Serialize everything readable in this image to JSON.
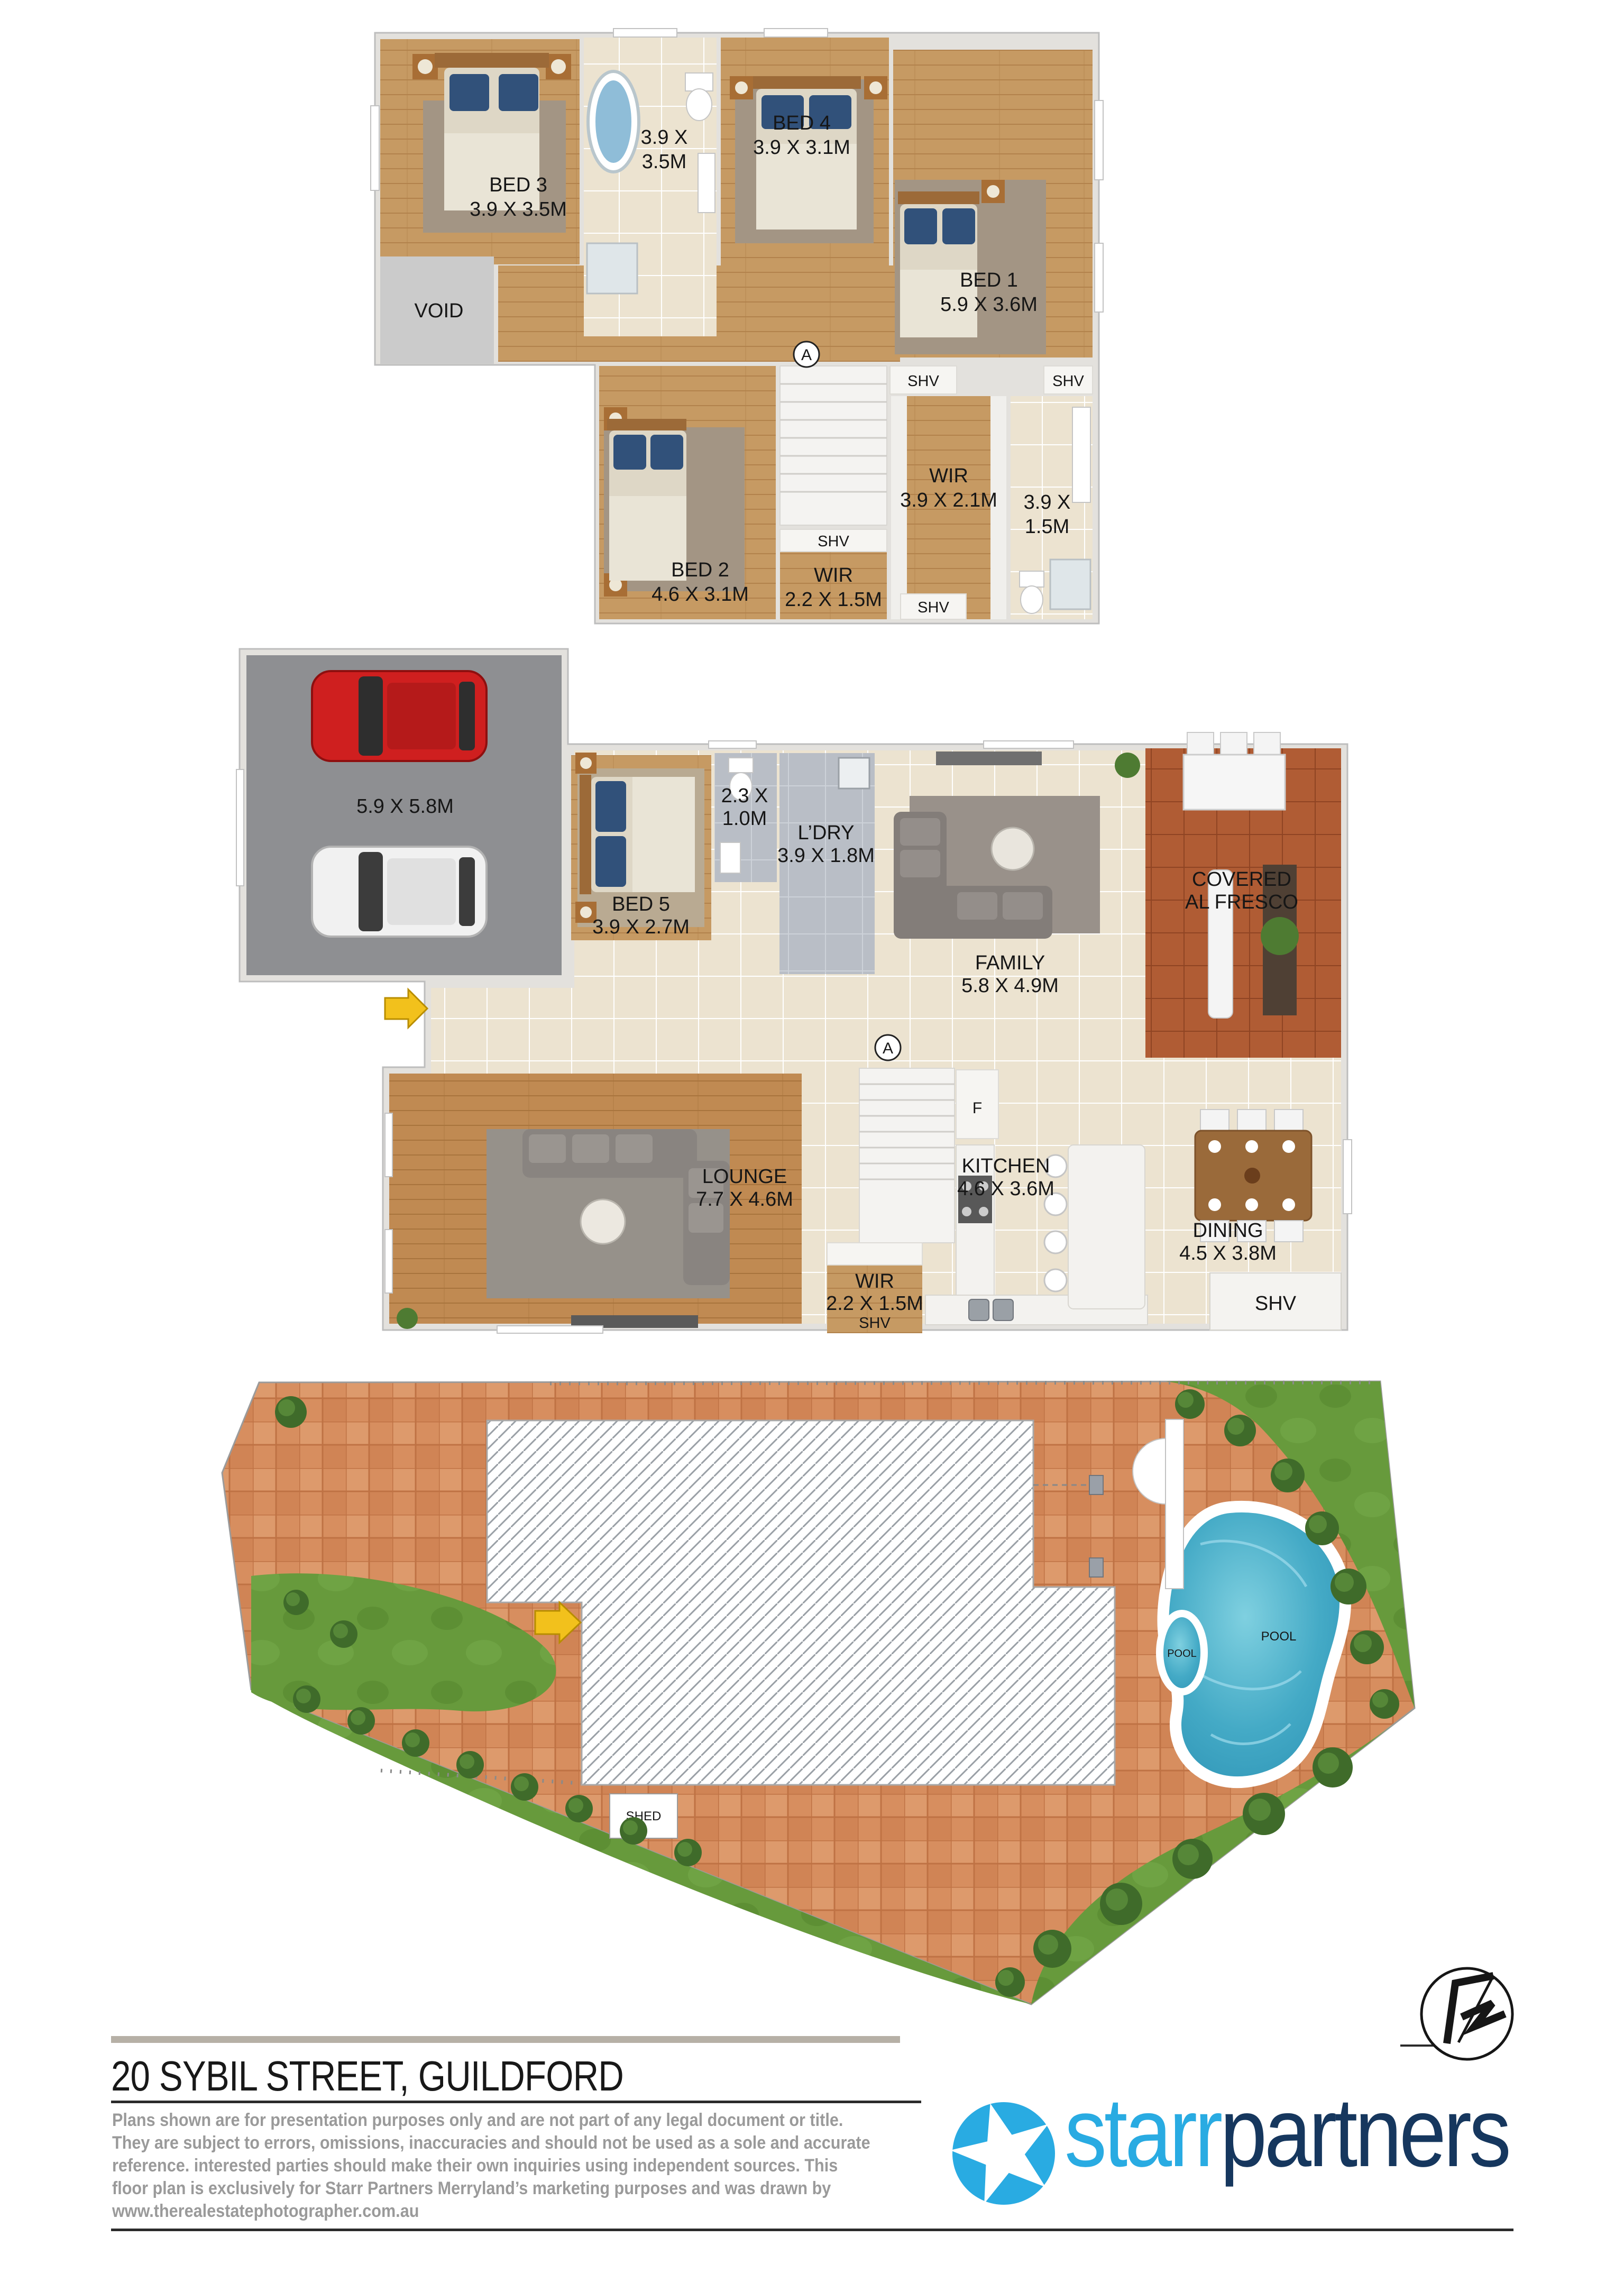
{
  "upper": {
    "bed3_name": "BED 3",
    "bed3_dims": "3.9 X 3.5M",
    "bath_dims_l1": "3.9 X",
    "bath_dims_l2": "3.5M",
    "bed4_name": "BED 4",
    "bed4_dims": "3.9 X 3.1M",
    "bed1_name": "BED 1",
    "bed1_dims": "5.9 X 3.6M",
    "void_label": "VOID",
    "section_marker": "A",
    "shv_a": "SHV",
    "shv_b": "SHV",
    "shv_c": "SHV",
    "shv_d": "SHV",
    "wir_name": "WIR",
    "wir_dims": "3.9 X 2.1M",
    "ens_dims_l1": "3.9 X",
    "ens_dims_l2": "1.5M",
    "bed2_name": "BED 2",
    "bed2_dims": "4.6 X 3.1M",
    "wir2_name": "WIR",
    "wir2_dims": "2.2 X 1.5M"
  },
  "ground": {
    "garage_dims": "5.9 X 5.8M",
    "bed5_name": "BED 5",
    "bed5_dims": "3.9 X 2.7M",
    "powder_dims_l1": "2.3 X",
    "powder_dims_l2": "1.0M",
    "ldry_name": "L’DRY",
    "ldry_dims": "3.9 X 1.8M",
    "family_name": "FAMILY",
    "family_dims": "5.8 X 4.9M",
    "alfresco_l1": "COVERED",
    "alfresco_l2": "AL FRESCO",
    "lounge_name": "LOUNGE",
    "lounge_dims": "7.7 X 4.6M",
    "kitchen_name": "KITCHEN",
    "kitchen_dims": "4.6 X 3.6M",
    "dining_name": "DINING",
    "dining_dims": "4.5 X 3.8M",
    "wir_name": "WIR",
    "wir_dims": "2.2 X 1.5M",
    "wir_shv": "SHV",
    "dining_shv": "SHV",
    "fridge_marker": "F",
    "section_marker": "A"
  },
  "site": {
    "shed_label": "SHED",
    "pool_main_label": "POOL",
    "pool_spa_label": "POOL"
  },
  "footer": {
    "title": "20 SYBIL STREET, GUILDFORD",
    "disclaimer_lines": [
      "Plans shown are for presentation purposes only and are not part  of  any  legal  document  or  title.",
      "They are subject to errors, omissions, inaccuracies and should not be used as a sole and accurate",
      "reference.  interested  parties  should  make  their  own  inquiries using independent sources. This",
      "floor plan is exclusively for Starr Partners Merryland’s  marketing  purposes  and  was  drawn  by",
      "www.therealestatephotographer.com.au"
    ]
  },
  "logo": {
    "part1": "starr",
    "part2": "partners"
  },
  "colors": {
    "logo_blue": "#29ABE2",
    "logo_navy": "#16375E",
    "wood_floor": "#c69a63",
    "lounge_floor": "#c08a52",
    "tile_cream": "#ece3d0",
    "tile_gray": "#b9bec6",
    "garage_gray": "#8e8f92",
    "terracotta": "#b05c34",
    "paving_orange": "#d78e5f",
    "grass_green": "#679a3c",
    "pool_blue": "#3ea9c6",
    "entry_arrow_yellow": "#f2c11c"
  }
}
